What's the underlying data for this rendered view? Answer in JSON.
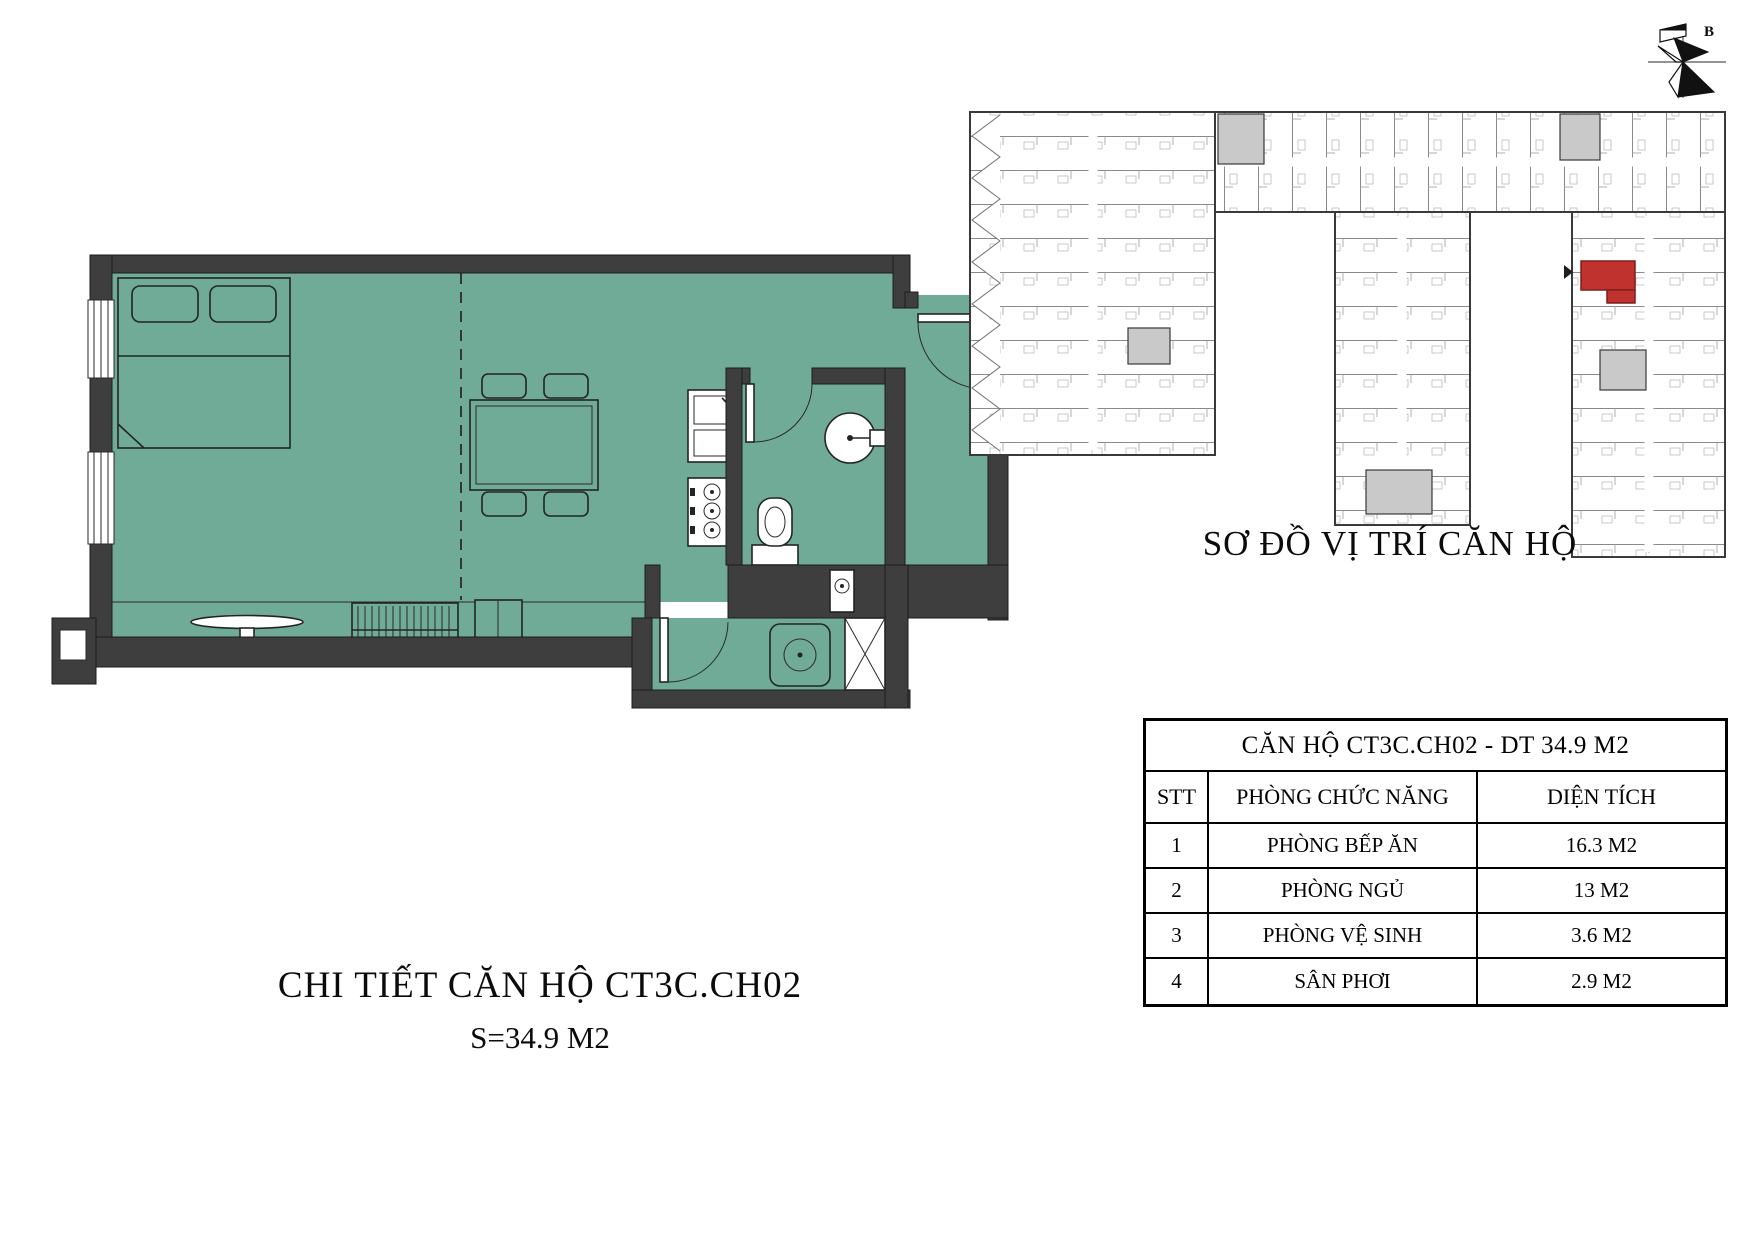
{
  "floor_plan": {
    "caption": "CHI TIẾT CĂN HỘ CT3C.CH02",
    "area_label": "S=34.9 M2"
  },
  "overview": {
    "title": "SƠ ĐỒ VỊ TRÍ CĂN HỘ"
  },
  "compass": {
    "north_label": "B"
  },
  "table": {
    "title": "CĂN HỘ CT3C.CH02 - DT 34.9 M2",
    "headers": {
      "stt": "STT",
      "room": "PHÒNG CHỨC NĂNG",
      "area": "DIỆN TÍCH"
    },
    "rows": [
      {
        "stt": "1",
        "room": "PHÒNG BẾP ĂN",
        "area": "16.3 M2"
      },
      {
        "stt": "2",
        "room": "PHÒNG NGỦ",
        "area": "13 M2"
      },
      {
        "stt": "3",
        "room": "PHÒNG VỆ SINH",
        "area": "3.6 M2"
      },
      {
        "stt": "4",
        "room": "SÂN PHƠI",
        "area": "2.9 M2"
      }
    ]
  },
  "colors": {
    "room_fill": "#6fab97",
    "wall": "#3e3e3e",
    "highlight_red": "#c0322d",
    "pointer_gray": "#4b4b4b"
  }
}
